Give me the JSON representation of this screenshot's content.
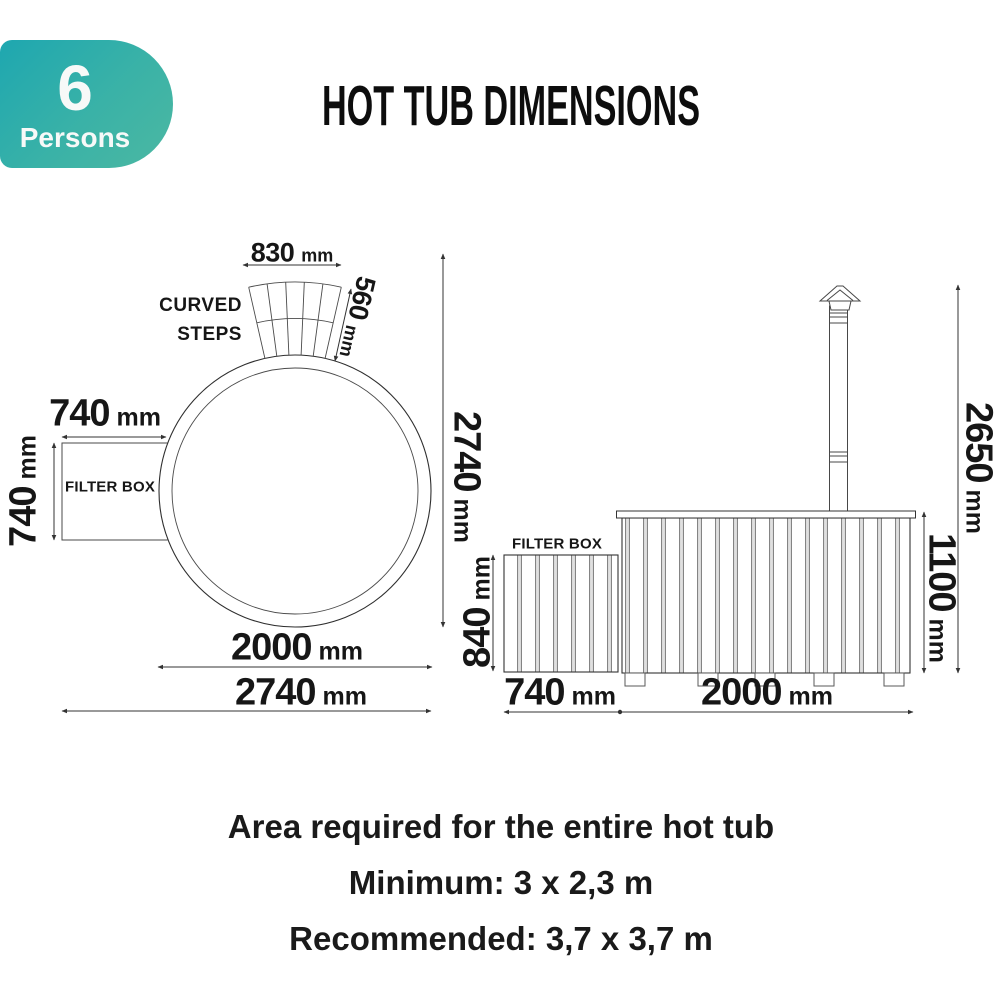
{
  "badge": {
    "count": "6",
    "label": "Persons"
  },
  "title": "HOT TUB DIMENSIONS",
  "top_view": {
    "steps_width_value": "830",
    "steps_width_unit": "mm",
    "steps_depth_value": "560",
    "steps_depth_unit": "mm",
    "steps_label_line1": "CURVED",
    "steps_label_line2": "STEPS",
    "filter_box_label": "FILTER BOX",
    "filter_width_value": "740",
    "filter_width_unit": "mm",
    "filter_depth_value": "740",
    "filter_depth_unit": "mm",
    "tub_diameter_value": "2000",
    "tub_diameter_unit": "mm",
    "overall_width_value": "2740",
    "overall_width_unit": "mm",
    "overall_depth_value": "2740",
    "overall_depth_unit": "mm"
  },
  "side_view": {
    "filter_box_label": "FILTER BOX",
    "filter_height_value": "840",
    "filter_height_unit": "mm",
    "filter_width_value": "740",
    "filter_width_unit": "mm",
    "tub_width_value": "2000",
    "tub_width_unit": "mm",
    "tub_height_value": "1100",
    "tub_height_unit": "mm",
    "overall_height_value": "2650",
    "overall_height_unit": "mm"
  },
  "footer": {
    "line1": "Area required for the entire hot tub",
    "line2": "Minimum: 3 x 2,3 m",
    "line3": "Recommended: 3,7 x 3,7 m"
  },
  "colors": {
    "badge_gradient_start": "#1ea7b0",
    "badge_gradient_end": "#4cb8a2",
    "line": "#333333",
    "text": "#111111"
  }
}
